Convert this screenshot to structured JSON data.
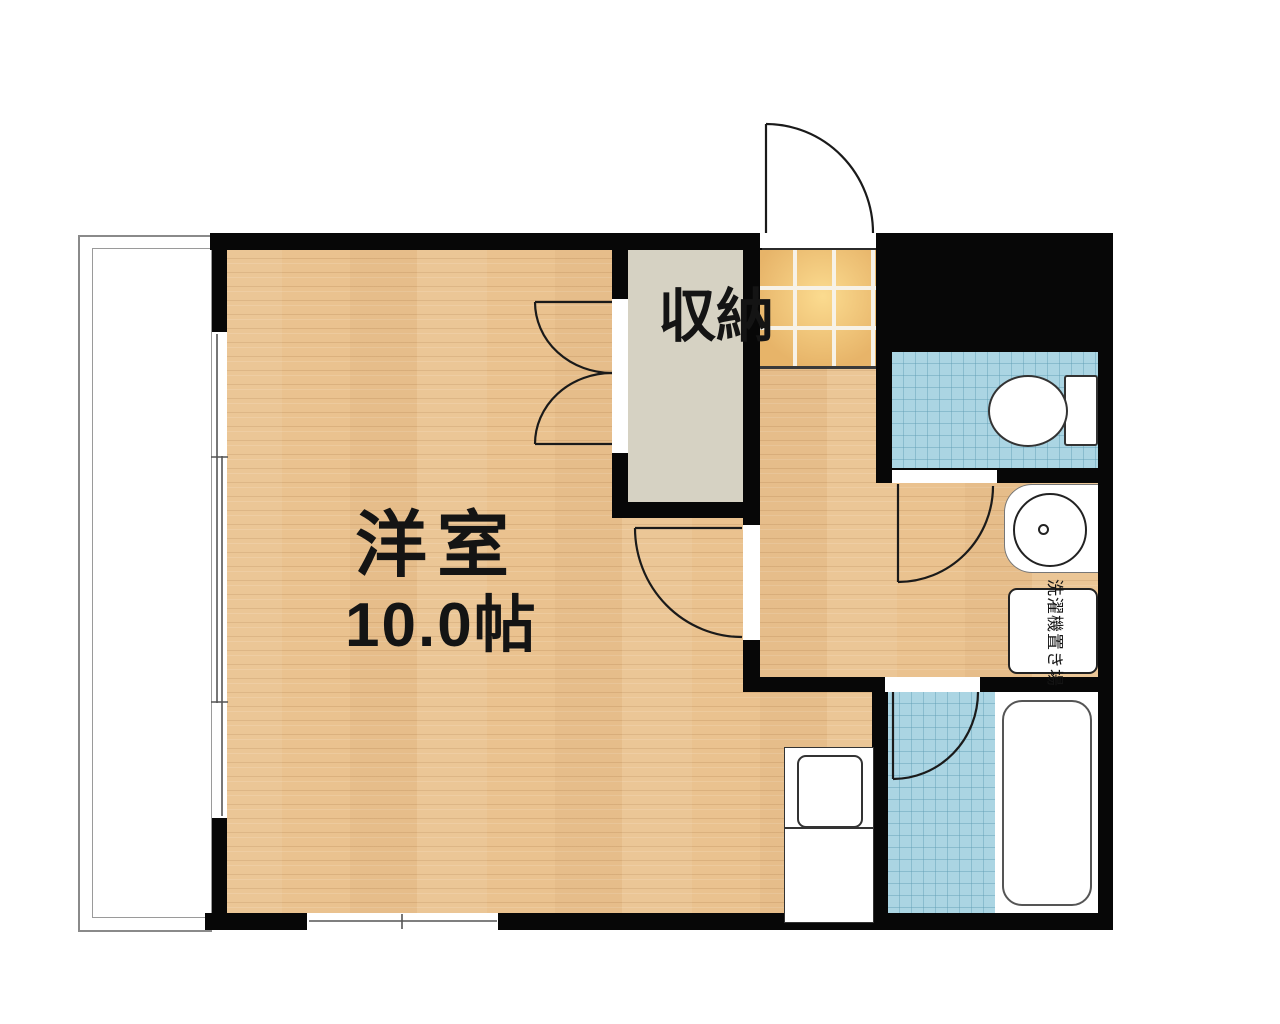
{
  "floor_plan": {
    "labels": {
      "main_room": "洋室",
      "main_room_size": "10.0帖",
      "closet": "収納",
      "laundry_space": "洗濯機置き場"
    },
    "rooms": [
      {
        "name": "western-room",
        "label": "洋室 10.0帖",
        "floor": "wood"
      },
      {
        "name": "closet",
        "label": "収納",
        "floor": "plain"
      },
      {
        "name": "entrance-genkan",
        "label": "",
        "floor": "orange-tile"
      },
      {
        "name": "hallway",
        "label": "",
        "floor": "wood"
      },
      {
        "name": "toilet-room",
        "label": "",
        "floor": "blue-tile"
      },
      {
        "name": "washroom",
        "label": "洗濯機置き場",
        "floor": "wood"
      },
      {
        "name": "bathroom",
        "label": "",
        "floor": "blue-tile"
      },
      {
        "name": "balcony",
        "label": "",
        "floor": "white"
      }
    ],
    "fixtures": [
      "entrance-door",
      "closet-double-doors",
      "room-door",
      "toilet-door",
      "bathroom-door",
      "toilet",
      "washbasin",
      "washing-machine-space",
      "bathtub",
      "kitchen-unit",
      "sliding-window-left",
      "sliding-window-bottom"
    ],
    "colors": {
      "wall": "#070707",
      "wood_floor": "#eac28f",
      "genkan_tile": "#e7b469",
      "genkan_grout": "#f7f2e7",
      "wet_area_tile": "#abd5e3",
      "wet_area_grid": "#5f9eb4",
      "closet_floor": "#d6d2c3",
      "fixture_outline": "#333333",
      "door_line": "#1a1a1a",
      "balcony_line": "#8a8a8a",
      "label_text": "#141414"
    }
  }
}
